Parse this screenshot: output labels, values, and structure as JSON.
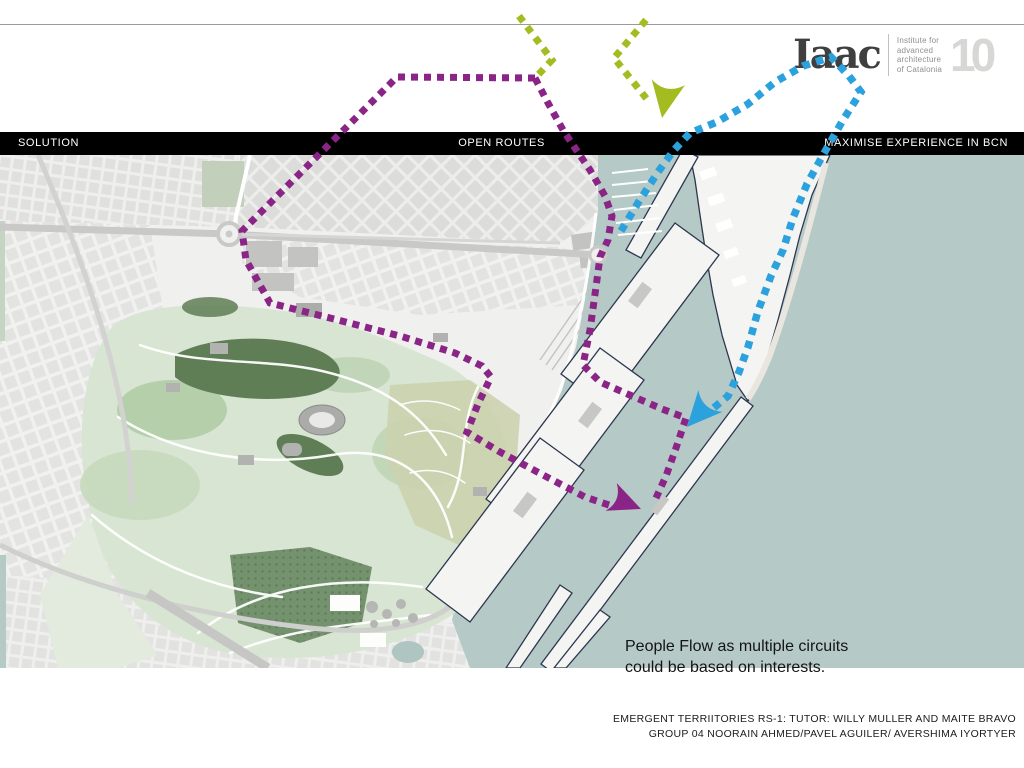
{
  "header_bar": {
    "left": "SOLUTION",
    "center": "OPEN ROUTES",
    "right": "MAXIMISE EXPERIENCE IN BCN"
  },
  "logo": {
    "wordmark": "Iaac",
    "institute_lines": [
      "Institute for",
      "advanced",
      "architecture",
      "of Catalonia"
    ],
    "anniversary": "10"
  },
  "annotation": {
    "line1": "People Flow as multiple circuits",
    "line2": "could be based on interests."
  },
  "footer": {
    "line1": "EMERGENT TERRIITORIES RS-1: TUTOR: WILLY MULLER AND MAITE BRAVO",
    "line2": "GROUP 04 NOORAIN AHMED/PAVEL AGUILER/ AVERSHIMA IYORTYER"
  },
  "theme": {
    "sea": "#b5c9c6",
    "land": "#f0f0ee",
    "pier": "#f4f4f2",
    "pierStroke": "#2c3650",
    "road": "#c9c9c7",
    "park": "#d8e5d3",
    "parkMid": "#aac79e",
    "parkDark": "#5f7e55",
    "cemetery": "#74926d",
    "khaki": "#cbd2ae",
    "barBg": "#000000",
    "barText": "#ffffff",
    "rule": "#9a9a9a",
    "purple": "#8b2487",
    "blue": "#2ba2de",
    "green": "#a5bc20"
  },
  "routes": {
    "arrow_path": "M0,0 L-28,-13 Q-18,0 -28,13 Z",
    "paths": [
      {
        "name": "purple-route-city-loop",
        "color": "#8b2487",
        "width": 7,
        "dash": "7 6",
        "points": [
          [
            535,
            78
          ],
          [
            397,
            77
          ],
          [
            242,
            231
          ],
          [
            246,
            260
          ],
          [
            270,
            303
          ],
          [
            330,
            318
          ],
          [
            400,
            336
          ],
          [
            455,
            353
          ],
          [
            482,
            366
          ],
          [
            491,
            377
          ],
          [
            478,
            404
          ],
          [
            467,
            432
          ],
          [
            500,
            452
          ],
          [
            543,
            475
          ],
          [
            585,
            497
          ],
          [
            612,
            506
          ]
        ],
        "arrow": {
          "x": 641,
          "y": 509,
          "angle": 22,
          "scale": 1.15
        }
      },
      {
        "name": "purple-route-port",
        "color": "#8b2487",
        "width": 7,
        "dash": "7 6",
        "points": [
          [
            535,
            78
          ],
          [
            548,
            103
          ],
          [
            563,
            130
          ],
          [
            575,
            148
          ],
          [
            590,
            170
          ],
          [
            605,
            196
          ],
          [
            612,
            216
          ],
          [
            608,
            240
          ],
          [
            600,
            257
          ],
          [
            596,
            287
          ],
          [
            590,
            330
          ],
          [
            583,
            365
          ],
          [
            600,
            382
          ],
          [
            632,
            396
          ],
          [
            662,
            409
          ],
          [
            686,
            418
          ],
          [
            676,
            448
          ],
          [
            666,
            476
          ],
          [
            656,
            498
          ]
        ]
      },
      {
        "name": "blue-route-coast",
        "color": "#2ba2de",
        "width": 7.5,
        "dash": "7.5 6.5",
        "points": [
          [
            621,
            231
          ],
          [
            638,
            203
          ],
          [
            658,
            172
          ],
          [
            674,
            150
          ],
          [
            690,
            133
          ],
          [
            717,
            122
          ],
          [
            748,
            104
          ],
          [
            775,
            82
          ],
          [
            803,
            66
          ],
          [
            831,
            57
          ],
          [
            849,
            76
          ],
          [
            861,
            92
          ],
          [
            843,
            120
          ],
          [
            823,
            155
          ],
          [
            807,
            184
          ],
          [
            793,
            218
          ],
          [
            783,
            250
          ],
          [
            771,
            276
          ],
          [
            758,
            311
          ],
          [
            748,
            347
          ],
          [
            739,
            372
          ],
          [
            728,
            396
          ],
          [
            710,
            411
          ],
          [
            698,
            416
          ]
        ],
        "arrow": {
          "x": 687,
          "y": 427,
          "angle": 132,
          "scale": 1.25
        }
      },
      {
        "name": "green-route-left",
        "color": "#a5bc20",
        "width": 7,
        "dash": "7 6.5",
        "points": [
          [
            519,
            16
          ],
          [
            552,
            60
          ],
          [
            537,
            76
          ]
        ]
      },
      {
        "name": "green-route-right",
        "color": "#a5bc20",
        "width": 7,
        "dash": "7 6.5",
        "points": [
          [
            646,
            20
          ],
          [
            614,
            58
          ],
          [
            650,
            103
          ]
        ],
        "arrow": {
          "x": 662,
          "y": 118,
          "angle": 100,
          "scale": 1.3
        }
      }
    ]
  }
}
